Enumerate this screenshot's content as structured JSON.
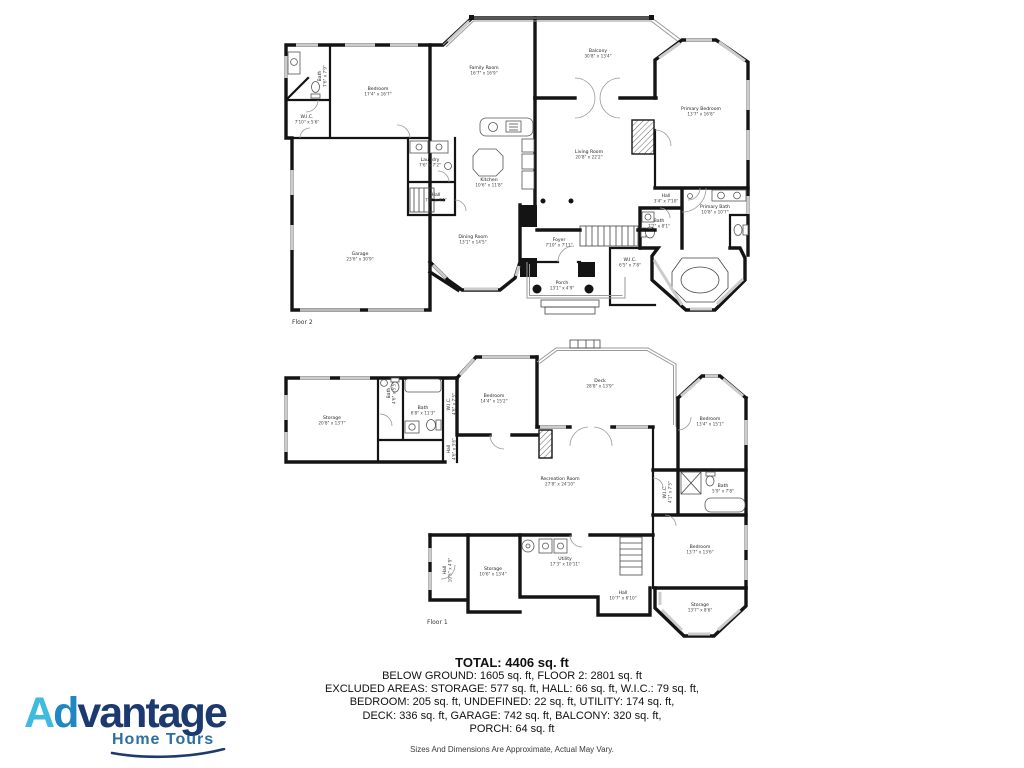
{
  "branding": {
    "logo_a": "A",
    "logo_d": "d",
    "logo_rest": "vantage",
    "tagline": "Home Tours",
    "colors": {
      "light_blue": "#41BADF",
      "mid_blue": "#1E87C4",
      "navy": "#1D3A70",
      "tag_blue": "#2F6EA0"
    }
  },
  "summary": {
    "total": "TOTAL: 4406 sq. ft",
    "line2": "BELOW GROUND: 1605 sq. ft, FLOOR 2: 2801 sq. ft",
    "line3": "EXCLUDED AREAS: STORAGE: 577 sq. ft, HALL: 66 sq. ft, W.I.C.: 79 sq. ft,",
    "line4": "BEDROOM: 205 sq. ft, UNDEFINED: 22 sq. ft, UTILITY: 174 sq. ft,",
    "line5": "DECK: 336 sq. ft, GARAGE: 742 sq. ft, BALCONY: 320 sq. ft,",
    "line6": "PORCH: 64 sq. ft",
    "disclaimer": "Sizes And Dimensions Are Approximate, Actual May Vary."
  },
  "floor2": {
    "name": "Floor 2",
    "rooms": [
      {
        "name": "Bedroom",
        "dims": "17'4\" x 16'7\"",
        "x": 378,
        "y": 90
      },
      {
        "name": "Bath",
        "dims": "7'6\" x 7'9\"",
        "x": 321,
        "y": 76,
        "rot": -90
      },
      {
        "name": "W.I.C.",
        "dims": "7'10\" x 5'6\"",
        "x": 307,
        "y": 118
      },
      {
        "name": "Garage",
        "dims": "23'6\" x 30'9\"",
        "x": 360,
        "y": 255
      },
      {
        "name": "Laundry",
        "dims": "7'6\" x 7'2\"",
        "x": 430,
        "y": 161
      },
      {
        "name": "Hall",
        "dims": "7'6\" x 4'1\"",
        "x": 436,
        "y": 196
      },
      {
        "name": "Family Room",
        "dims": "16'7\" x 16'9\"",
        "x": 484,
        "y": 69
      },
      {
        "name": "Kitchen",
        "dims": "10'6\" x 11'8\"",
        "x": 489,
        "y": 181
      },
      {
        "name": "Dining Room",
        "dims": "13'1\" x 14'5\"",
        "x": 473,
        "y": 238
      },
      {
        "name": "Balcony",
        "dims": "30'8\" x 13'4\"",
        "x": 598,
        "y": 52
      },
      {
        "name": "Living Room",
        "dims": "20'8\" x 22'2\"",
        "x": 589,
        "y": 153
      },
      {
        "name": "Primary Bedroom",
        "dims": "13'7\" x 16'8\"",
        "x": 701,
        "y": 110
      },
      {
        "name": "Hall",
        "dims": "3'4\" x 7'10\"",
        "x": 666,
        "y": 197
      },
      {
        "name": "Bath",
        "dims": "7'2\" x 8'1\"",
        "x": 659,
        "y": 222
      },
      {
        "name": "Primary Bath",
        "dims": "10'8\" x 10'7\"",
        "x": 715,
        "y": 208
      },
      {
        "name": "W.I.C.",
        "dims": "6'5\" x 7'8\"",
        "x": 630,
        "y": 261
      },
      {
        "name": "Foyer",
        "dims": "7'10\" x 7'11\"",
        "x": 559,
        "y": 241
      },
      {
        "name": "Porch",
        "dims": "13'1\" x 4'9\"",
        "x": 562,
        "y": 284
      }
    ]
  },
  "floor1": {
    "name": "Floor 1",
    "rooms": [
      {
        "name": "Storage",
        "dims": "20'8\" x 13'7\"",
        "x": 332,
        "y": 419
      },
      {
        "name": "Bath",
        "dims": "4'6\" x 5'5\"",
        "x": 390,
        "y": 393,
        "rot": -90
      },
      {
        "name": "Bath",
        "dims": "6'8\" x 11'3\"",
        "x": 423,
        "y": 409
      },
      {
        "name": "W.I.C.",
        "dims": "4'6\" x 7'5\"",
        "x": 450,
        "y": 404,
        "rot": -90
      },
      {
        "name": "Hall",
        "dims": "4'6\" x 3'6\"",
        "x": 450,
        "y": 449,
        "rot": -90
      },
      {
        "name": "Bedroom",
        "dims": "14'4\" x 15'2\"",
        "x": 494,
        "y": 397
      },
      {
        "name": "Deck",
        "dims": "28'8\" x 13'9\"",
        "x": 600,
        "y": 382
      },
      {
        "name": "Bedroom",
        "dims": "13'4\" x 15'1\"",
        "x": 710,
        "y": 420
      },
      {
        "name": "W.I.C.",
        "dims": "4'1\" x 7'5\"",
        "x": 666,
        "y": 492,
        "rot": -90
      },
      {
        "name": "Bath",
        "dims": "5'9\" x 7'8\"",
        "x": 723,
        "y": 487
      },
      {
        "name": "Recreation Room",
        "dims": "27'8\" x 24'10\"",
        "x": 560,
        "y": 480
      },
      {
        "name": "Hall",
        "dims": "10'5\" x 4'9\"",
        "x": 446,
        "y": 570,
        "rot": -90
      },
      {
        "name": "Storage",
        "dims": "10'6\" x 13'4\"",
        "x": 493,
        "y": 570
      },
      {
        "name": "Utility",
        "dims": "17'3\" x 10'11\"",
        "x": 565,
        "y": 560
      },
      {
        "name": "Hall",
        "dims": "10'7\" x 6'10\"",
        "x": 623,
        "y": 594
      },
      {
        "name": "Bedroom",
        "dims": "13'7\" x 13'6\"",
        "x": 700,
        "y": 548
      },
      {
        "name": "Storage",
        "dims": "13'7\" x 8'6\"",
        "x": 700,
        "y": 606
      }
    ]
  }
}
